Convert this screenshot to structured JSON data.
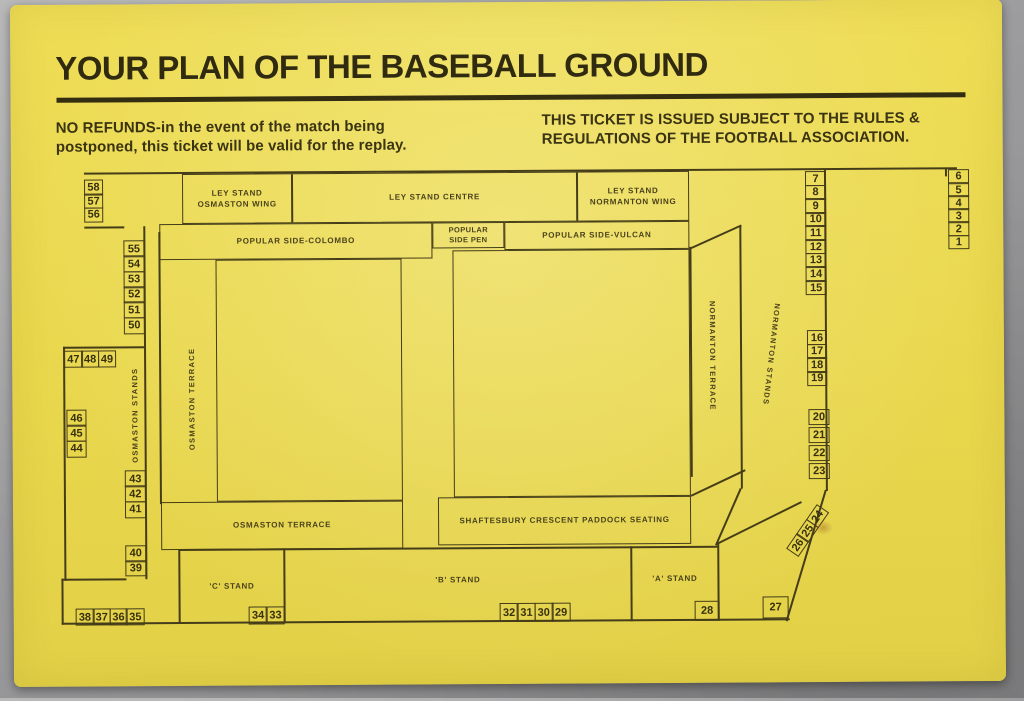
{
  "header": {
    "title": "YOUR PLAN OF THE BASEBALL GROUND"
  },
  "notices": {
    "refund": "NO REFUNDS-in the event of the match being\npostponed, this ticket will be valid for the replay.",
    "rules": "THIS TICKET IS ISSUED SUBJECT TO THE RULES &\nREGULATIONS OF THE FOOTBALL ASSOCIATION."
  },
  "plan": {
    "ley_osmaston": "LEY STAND\nOSMASTON WING",
    "ley_centre": "LEY STAND CENTRE",
    "ley_normanton": "LEY STAND\nNORMANTON WING",
    "popular_colombo": "POPULAR SIDE-COLOMBO",
    "popular_pen": "POPULAR\nSIDE PEN",
    "popular_vulcan": "POPULAR SIDE-VULCAN",
    "osmaston_stands": "OSMASTON STANDS",
    "osmaston_terrace_side": "OSMASTON TERRACE",
    "osmaston_terrace_end": "OSMASTON TERRACE",
    "normanton_terrace": "NORMANTON TERRACE",
    "normanton_stands": "NORMANTON STANDS",
    "shaftesbury": "SHAFTESBURY CRESCENT PADDOCK SEATING",
    "stand_a": "'A' STAND",
    "stand_b": "'B' STAND",
    "stand_c": "'C' STAND"
  },
  "gates": {
    "g58": [
      "58",
      "57",
      "56"
    ],
    "g55": [
      "55",
      "54",
      "53",
      "52",
      "51",
      "50"
    ],
    "g47": [
      "47",
      "48",
      "49"
    ],
    "g46": [
      "46",
      "45",
      "44"
    ],
    "g43": [
      "43",
      "42",
      "41"
    ],
    "g40": [
      "40",
      "39"
    ],
    "g38": [
      "38",
      "37",
      "36",
      "35"
    ],
    "g34": [
      "34",
      "33"
    ],
    "g32": [
      "32",
      "31",
      "30",
      "29"
    ],
    "g28": [
      "28"
    ],
    "g27": [
      "27"
    ],
    "g24": [
      "26",
      "25",
      "24"
    ],
    "g7": [
      "7",
      "8",
      "9",
      "10",
      "11",
      "12",
      "13",
      "14",
      "15"
    ],
    "g16": [
      "16",
      "17",
      "18",
      "19"
    ],
    "g20": [
      "20",
      "21",
      "22",
      "23"
    ],
    "g6": [
      "6",
      "5",
      "4",
      "3",
      "2",
      "1"
    ]
  },
  "colors": {
    "card": "#ead84e",
    "ink": "#453d19",
    "background": "#9a9a9b"
  }
}
